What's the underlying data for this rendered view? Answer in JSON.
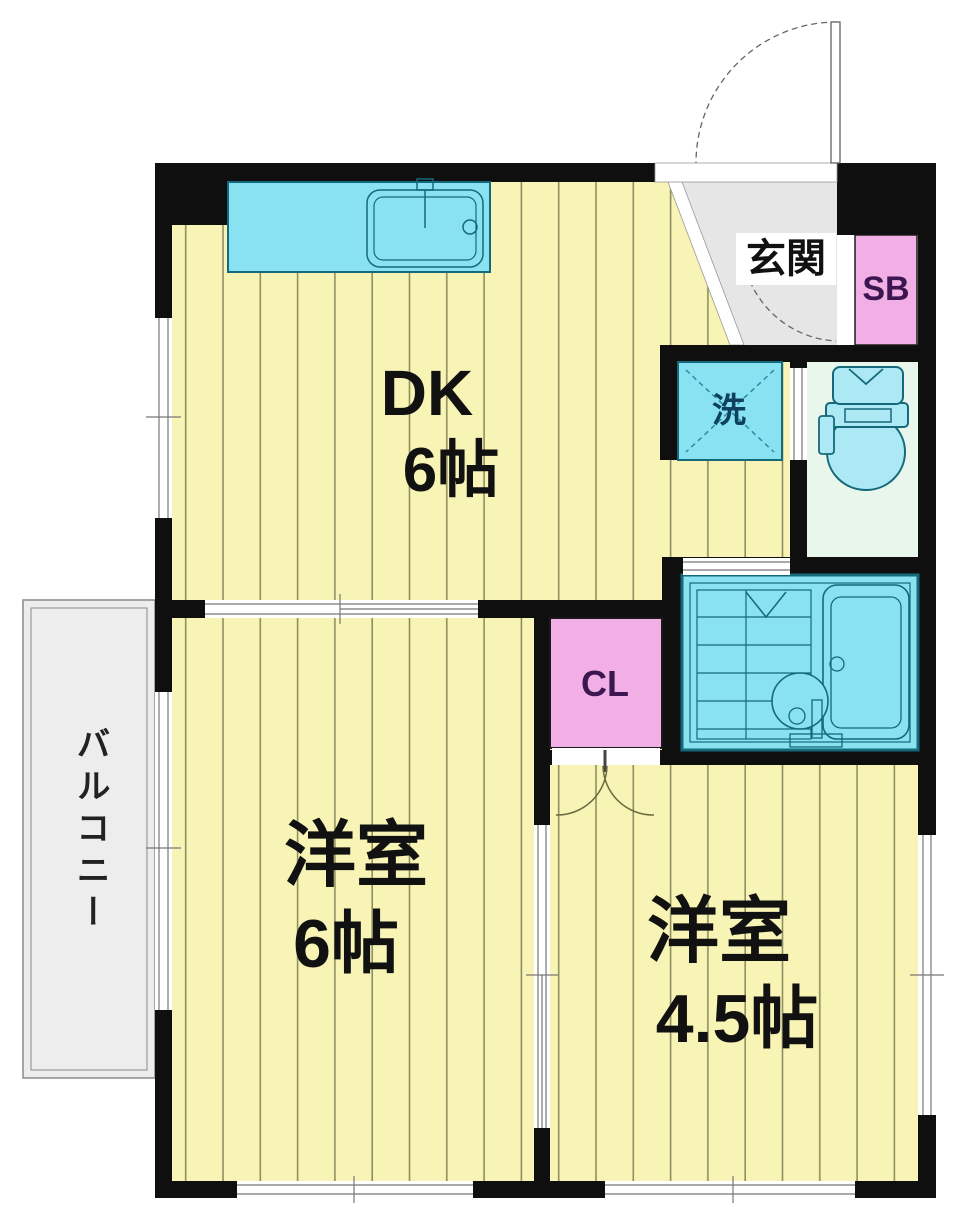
{
  "labels": {
    "genkan": "玄関",
    "shoe_box": "SB",
    "washer": "洗",
    "closet": "CL",
    "balcony": "バルコニー"
  },
  "rooms": {
    "dk": {
      "name": "DK",
      "size": "6帖"
    },
    "western6": {
      "name": "洋室",
      "size": "6帖"
    },
    "western45": {
      "name": "洋室",
      "size": "4.5帖"
    }
  },
  "colors": {
    "floor": "#f8f4b6",
    "stripe": "#8f8f60",
    "wall": "#0f0f0f",
    "fixture_cyan": "#89e2f1",
    "fixture_stroke": "#14697a",
    "toilet_floor": "#e8f6eb",
    "genkan_gray": "#e6e6e6",
    "balcony_gray": "#ededed",
    "accent_pink": "#f2afe6",
    "label_purple": "#3c1650",
    "washer_text": "#10405e"
  }
}
